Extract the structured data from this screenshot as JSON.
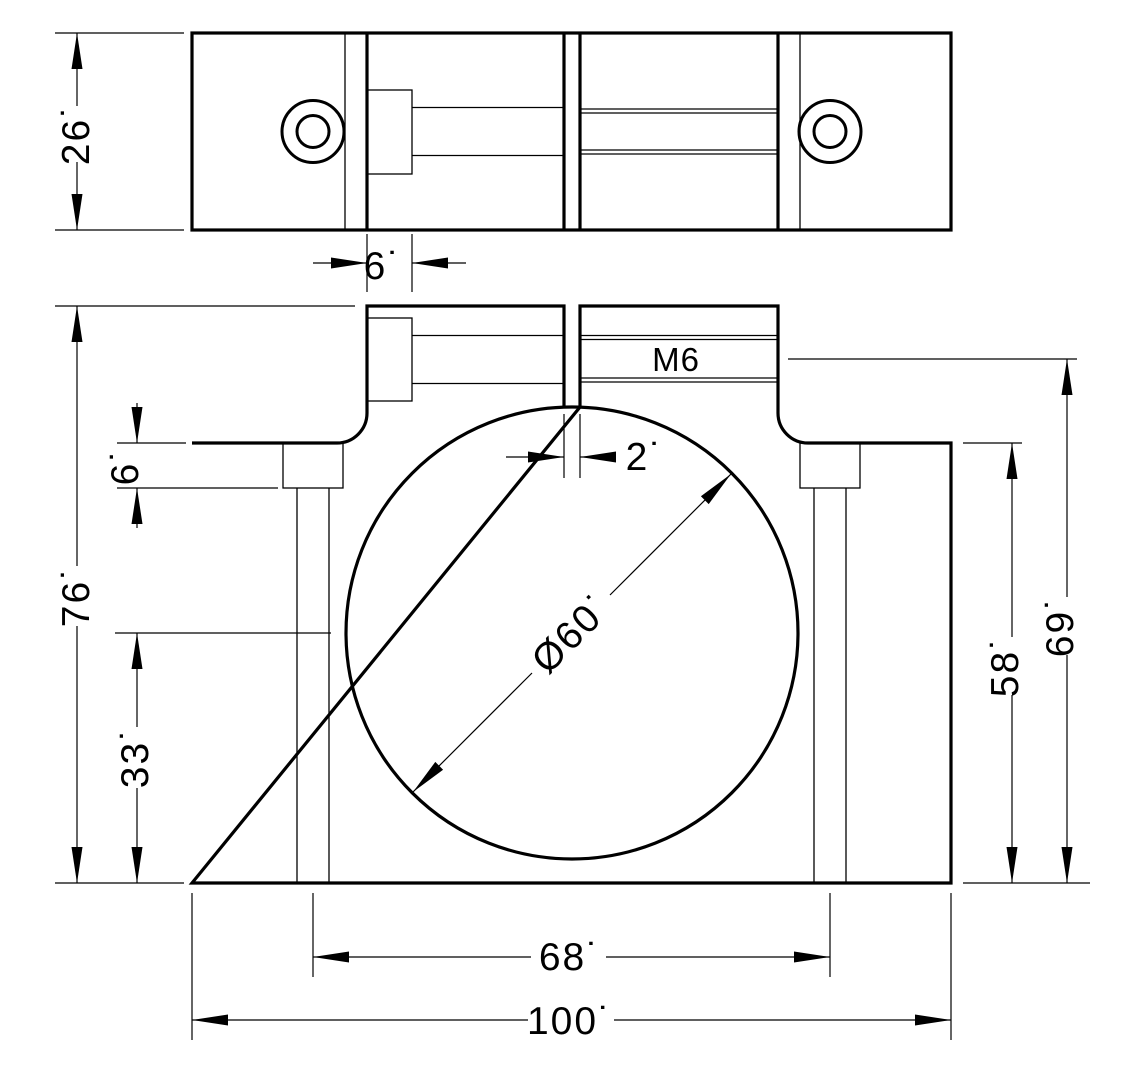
{
  "page": {
    "background_color": "#ffffff",
    "line_color": "#000000"
  },
  "top_view": {
    "dims": {
      "height": "26˙",
      "counterbore_depth": "6˙"
    }
  },
  "front_view": {
    "thread_callout": "M6",
    "dims": {
      "overall_height": "76˙",
      "base_counterbore_depth": "6˙",
      "bore_center_height": "33˙",
      "slot_width": "2˙",
      "bore_diameter": "Ø60˙",
      "clamp_screw_axis_height": "69˙",
      "shoulder_height": "58˙",
      "hole_spacing": "68˙",
      "overall_width": "100˙"
    }
  }
}
